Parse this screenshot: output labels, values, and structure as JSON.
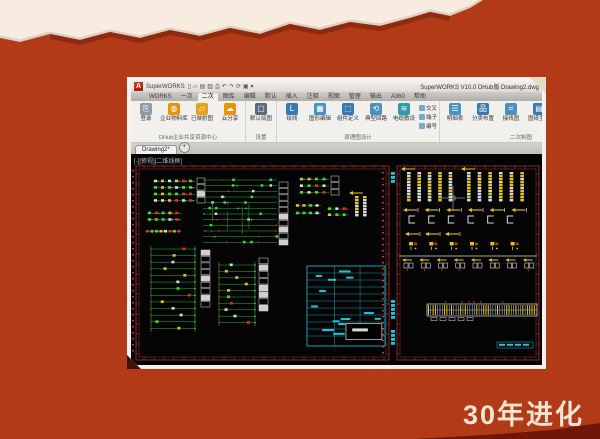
{
  "slide": {
    "background": "#b23a17",
    "cream": "#f7ecdf",
    "shadow_tan": "#dbcfc0",
    "torn_dark_edge": "#8e2a10",
    "corner_dark": "#6f1808",
    "caption": "30年进化",
    "caption_color": "#f3e4d4"
  },
  "window": {
    "logo_letter": "A",
    "title_left": "SuperWORKS",
    "title_right": "SuperWORKS V10.0 DHub版    Drawing2.dwg",
    "qat_icons": [
      {
        "name": "new-file-icon",
        "glyph": "▯"
      },
      {
        "name": "open-icon",
        "glyph": "▱"
      },
      {
        "name": "save-icon",
        "glyph": "▤"
      },
      {
        "name": "save-as-icon",
        "glyph": "▥"
      },
      {
        "name": "plot-icon",
        "glyph": "⎙"
      },
      {
        "name": "undo-icon",
        "glyph": "↶"
      },
      {
        "name": "redo-icon",
        "glyph": "↷"
      },
      {
        "name": "refresh-icon",
        "glyph": "⟳"
      },
      {
        "name": "workspace-icon",
        "glyph": "▣"
      },
      {
        "name": "dropdown-icon",
        "glyph": "▾"
      }
    ],
    "tabs": [
      "WORKS",
      "一次",
      "二次",
      "图库",
      "编辑",
      "默认",
      "插入",
      "注释",
      "视图",
      "管理",
      "输出",
      "A360",
      "帮助"
    ],
    "active_tab_index": 2,
    "ribbon_groups": [
      {
        "label": "DHub企业共享资源中心",
        "buttons": [
          {
            "label": "登录",
            "glyph": "⎘",
            "color": "#8f9aa6"
          },
          {
            "label": "企业物料库",
            "glyph": "◍",
            "color": "#e8930c"
          },
          {
            "label": "已映射图",
            "glyph": "▱",
            "color": "#e8a31c"
          },
          {
            "label": "云分享",
            "glyph": "☁",
            "color": "#e8930c"
          }
        ],
        "small": []
      },
      {
        "label": "设置",
        "buttons": [
          {
            "label": "默认绘图",
            "glyph": "▢",
            "color": "#5b6b7b"
          }
        ],
        "small": []
      },
      {
        "label": "原理图设计",
        "buttons": [
          {
            "label": "绘线",
            "glyph": "L",
            "color": "#3a78b5"
          },
          {
            "label": "图形编辑",
            "glyph": "▦",
            "color": "#4a90c2"
          },
          {
            "label": "组件定义",
            "glyph": "⬚",
            "color": "#3a78b5"
          },
          {
            "label": "典型回路",
            "glyph": "⟲",
            "color": "#4a90c2"
          },
          {
            "label": "电缆敷设",
            "glyph": "≋",
            "color": "#2f9aa8"
          }
        ],
        "small": [
          {
            "label": "交叉",
            "color": "#7aa8cc"
          },
          {
            "label": "端子",
            "color": "#7aa8cc"
          },
          {
            "label": "编号",
            "color": "#7aa8cc"
          }
        ]
      },
      {
        "label": "二次制图",
        "buttons": [
          {
            "label": "明细表",
            "glyph": "☰",
            "color": "#4a90c2"
          },
          {
            "label": "分类布置",
            "glyph": "品",
            "color": "#3a78b5"
          },
          {
            "label": "接线图",
            "glyph": "⌗",
            "color": "#4a90c2"
          },
          {
            "label": "图纸生成",
            "glyph": "▤",
            "color": "#3a78b5"
          },
          {
            "label": "标注表",
            "glyph": "▦",
            "color": "#2f9aa8"
          }
        ],
        "small": [
          {
            "label": "表格",
            "color": "#9aa8b4"
          },
          {
            "label": "导出",
            "color": "#9aa8b4"
          },
          {
            "label": "设置",
            "color": "#9aa8b4"
          }
        ]
      }
    ],
    "doc_tab": "Drawing2*",
    "doc_tab_plus": "+",
    "viewport_control": "[-][俯视][二维线框]"
  },
  "canvas": {
    "colors": {
      "bg": "#040404",
      "frame": "#7e2424",
      "frame2": "#a03030",
      "green": "#1db83c",
      "green2": "#3ae02a",
      "red": "#e03222",
      "white": "#dadada",
      "yellow": "#e8c21a",
      "cyan": "#19c8dc",
      "brown": "#9a4a10",
      "gray": "#9a9a9a"
    },
    "sheets": [
      {
        "x": 5,
        "y": 12,
        "w": 253,
        "h": 194
      },
      {
        "x": 266,
        "y": 12,
        "w": 142,
        "h": 194
      }
    ],
    "clusters": [
      {
        "type": "edgecol",
        "x": 1,
        "y": 16,
        "h": 186,
        "color": "red"
      },
      {
        "type": "edgecol",
        "x": 251,
        "y": 18,
        "h": 182,
        "color": "red"
      },
      {
        "type": "cyanstack",
        "x": 260,
        "y": 18,
        "n": 3
      },
      {
        "type": "cyanstack",
        "x": 260,
        "y": 146,
        "n": 5
      },
      {
        "type": "cyanstack",
        "x": 260,
        "y": 176,
        "n": 4
      },
      {
        "type": "grid",
        "x": 22,
        "y": 24,
        "w": 42,
        "h": 26,
        "rows": 4,
        "cols": 6
      },
      {
        "type": "labels",
        "x": 66,
        "y": 24,
        "w": 8,
        "h": 26,
        "rows": 4
      },
      {
        "type": "grid",
        "x": 16,
        "y": 56,
        "w": 34,
        "h": 13,
        "rows": 2,
        "cols": 5
      },
      {
        "type": "grid",
        "x": 14,
        "y": 74,
        "w": 36,
        "h": 7,
        "rows": 1,
        "cols": 8
      },
      {
        "type": "hlines",
        "x": 72,
        "y": 26,
        "w": 74,
        "h": 68,
        "rows": 12
      },
      {
        "type": "labels",
        "x": 148,
        "y": 28,
        "w": 9,
        "h": 64,
        "rows": 10
      },
      {
        "type": "grid",
        "x": 168,
        "y": 22,
        "w": 30,
        "h": 20,
        "rows": 3,
        "cols": 4
      },
      {
        "type": "labels",
        "x": 200,
        "y": 22,
        "w": 8,
        "h": 20,
        "rows": 3
      },
      {
        "type": "grid",
        "x": 164,
        "y": 48,
        "w": 26,
        "h": 15,
        "rows": 2,
        "cols": 4
      },
      {
        "type": "grid",
        "x": 196,
        "y": 52,
        "w": 22,
        "h": 12,
        "rows": 2,
        "cols": 3
      },
      {
        "type": "ybars",
        "x": 224,
        "y": 42,
        "w": 16,
        "h": 22,
        "cols": 2
      },
      {
        "type": "ladder",
        "x": 18,
        "y": 92,
        "w": 48,
        "h": 86,
        "rungs": 13
      },
      {
        "type": "labels",
        "x": 70,
        "y": 96,
        "w": 9,
        "h": 58,
        "rows": 9
      },
      {
        "type": "ladder",
        "x": 86,
        "y": 108,
        "w": 40,
        "h": 64,
        "rungs": 10
      },
      {
        "type": "labels",
        "x": 128,
        "y": 104,
        "w": 9,
        "h": 54,
        "rows": 8
      },
      {
        "type": "cyantable",
        "x": 176,
        "y": 112,
        "w": 78,
        "h": 80
      },
      {
        "type": "ybars",
        "x": 276,
        "y": 18,
        "w": 52,
        "h": 30,
        "cols": 5
      },
      {
        "type": "ybars",
        "x": 336,
        "y": 18,
        "w": 64,
        "h": 30,
        "cols": 6
      },
      {
        "type": "yarrows",
        "x": 272,
        "y": 52,
        "w": 130,
        "h": 8,
        "n": 6
      },
      {
        "type": "cshapes",
        "x": 278,
        "y": 62,
        "w": 118,
        "h": 9,
        "n": 6
      },
      {
        "type": "yarrows",
        "x": 274,
        "y": 76,
        "w": 60,
        "h": 8,
        "n": 3
      },
      {
        "type": "ysymbols",
        "x": 278,
        "y": 88,
        "w": 122,
        "h": 12,
        "n": 6
      },
      {
        "type": "termrow",
        "x": 268,
        "y": 102,
        "w": 138,
        "h": 18,
        "n": 8
      },
      {
        "type": "strip",
        "x": 296,
        "y": 150,
        "w": 110,
        "h": 20
      },
      {
        "type": "cyantext",
        "x": 366,
        "y": 188,
        "w": 36,
        "h": 6
      },
      {
        "type": "crosshair",
        "x": 322,
        "y": 44
      }
    ]
  }
}
